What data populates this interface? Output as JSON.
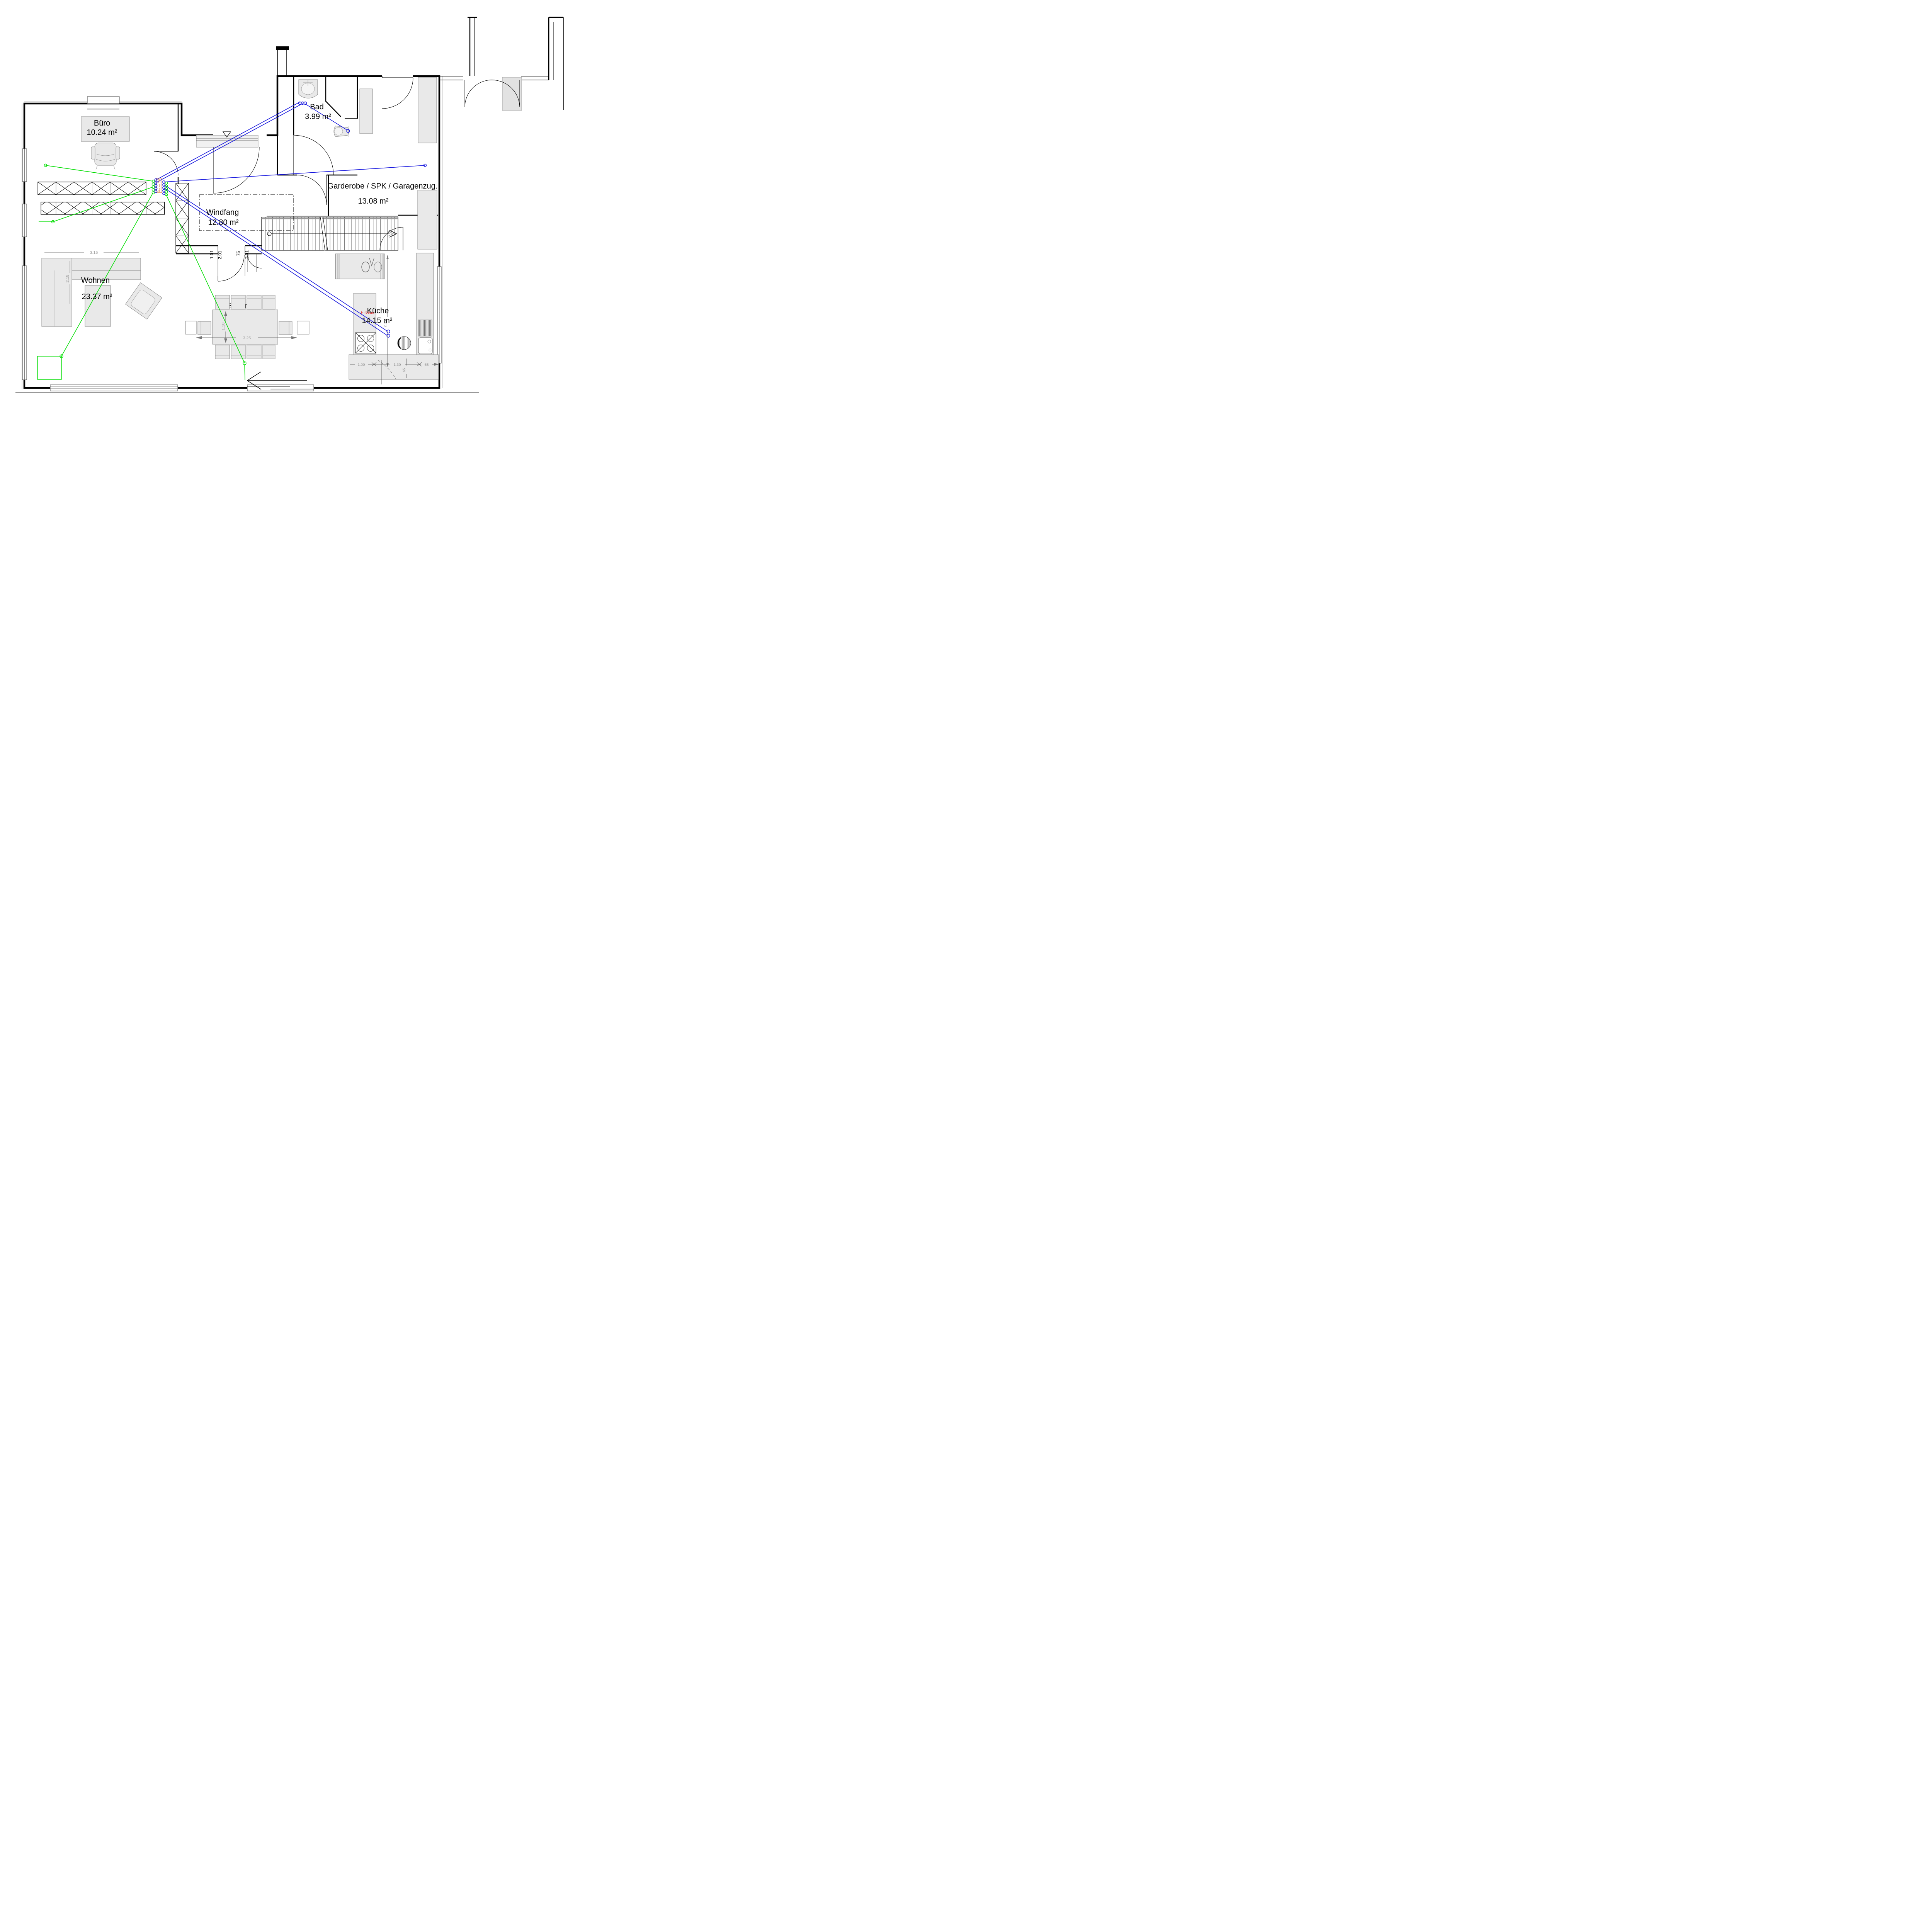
{
  "title": "Erdgeschoss Grundriss",
  "rooms": [
    {
      "key": "buero",
      "name": "Büro",
      "area": "10.24 m²"
    },
    {
      "key": "bad",
      "name": "Bad",
      "area": "3.99 m²"
    },
    {
      "key": "garderobe",
      "name": "Garderobe / SPK / Garagenzug.",
      "area": "13.08 m²"
    },
    {
      "key": "windfang",
      "name": "Windfang",
      "area": "12.80 m²"
    },
    {
      "key": "wohnen",
      "name": "Wohnen",
      "area": "23.37 m²"
    },
    {
      "key": "kueche",
      "name": "Küche",
      "area": "14.15 m²"
    },
    {
      "key": "essen",
      "name": "Essen",
      "area": ""
    }
  ],
  "annotations": {
    "mauer_og": "Mauer OG",
    "kueche_height": "H=96cm"
  },
  "dimensions": {
    "door_main_width": "1.01",
    "door_main_height": "2.01",
    "door_small_width": "75",
    "door_small_height": "2.01",
    "sofa_width": "3.15",
    "sofa_depth": "2.15",
    "table_width": "3.25",
    "table_depth": "1.10",
    "kitchen_depth": "2.35",
    "kitchen_seg1": "1.00",
    "kitchen_seg2": "1.30",
    "kitchen_seg3": "65",
    "kitchen_seg4": "65"
  },
  "colors": {
    "cable_green": "#00dd00",
    "cable_blue": "#1515dd",
    "annotation_orange": "#e07a28",
    "annotation_red": "#dd2222",
    "furniture_fill": "#e9e9e9",
    "wall": "#000000"
  }
}
